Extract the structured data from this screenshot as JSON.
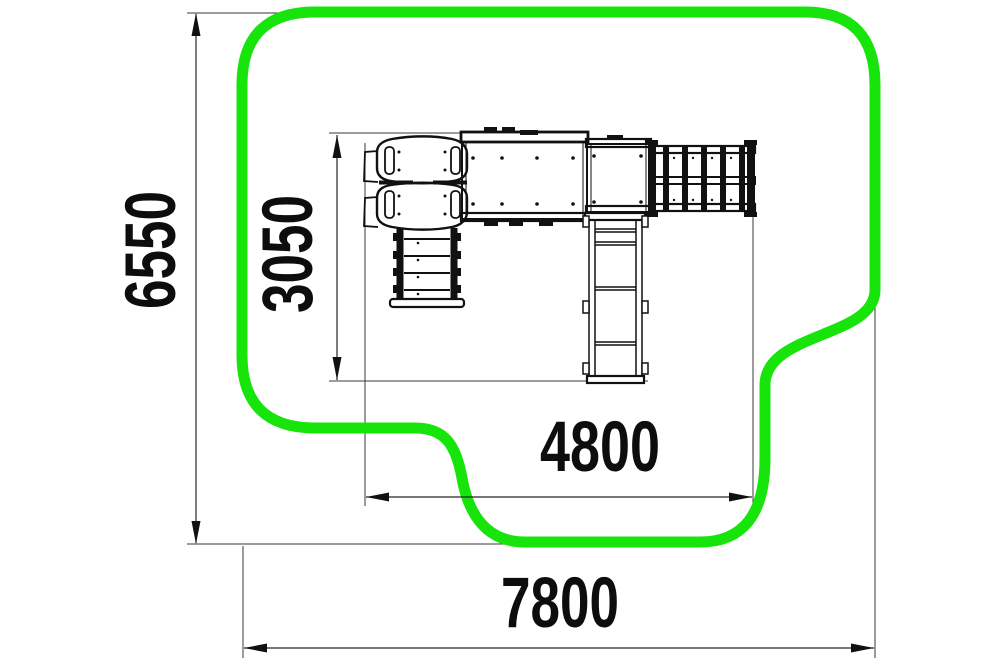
{
  "drawing": {
    "dimensions": {
      "overall_height_mm": "6550",
      "inner_height_mm": "3050",
      "inner_width_mm": "4800",
      "overall_width_mm": "7800"
    },
    "colors": {
      "safety_zone_green": "#17E40A",
      "linework": "#111111",
      "dimension_lines": "#3a3a3a",
      "background": "#ffffff"
    }
  }
}
